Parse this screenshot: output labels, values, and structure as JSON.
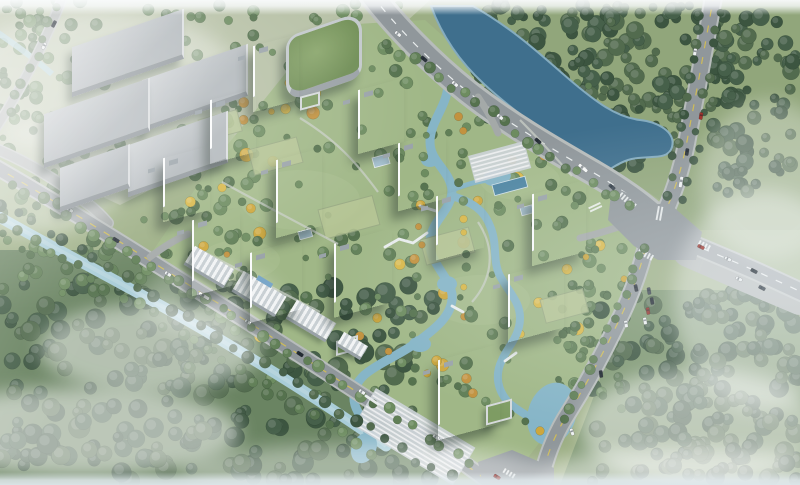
{
  "meta": {
    "title": "aerial-residential-development-render",
    "viewport": {
      "w": 800,
      "h": 485
    },
    "description": "Bird's-eye architectural rendering: riverside residential compound of white high-rise towers with landscaped gardens and winding stream, bounded by arterial roads, a large intersection, canal, warehouses and forest"
  },
  "palette": {
    "base": "#9cae84",
    "paleField": "#b6c0a5",
    "grassNE": "#91a67b",
    "forestBaseSW": "#6a8462",
    "forestBaseSE": "#7d9670",
    "lawn": "#a0b787",
    "lawnLight": "#aabf90",
    "courtyard": "#b7c696",
    "courtyardEdge": "#98a883",
    "river": "#3f6f8d",
    "riverEdge": "#85acbf",
    "canal": "#a9cdd8",
    "canalLight": "#c6dee5",
    "stream": "#86b5c7",
    "pool": "#4f86a3",
    "pavilion": "#a8c3d2",
    "roadAsphalt": "#90979b",
    "roadSide": "#b7bcbb",
    "roadMinor": "#a4a9a8",
    "laneWhite": "#f3f6f6",
    "laneYellow": "#d6c050",
    "greensDark": [
      "#3c5540",
      "#46604a",
      "#526b4e"
    ],
    "greensMid": [
      "#55724e",
      "#617f57",
      "#6d8c60"
    ],
    "yellows": [
      "#cda73d",
      "#c2923f",
      "#d8b84a"
    ],
    "pathGrey": "#c9cfc7",
    "terrace": "#ccd3d7",
    "terraceLine": "#eef0f1",
    "bridge": "#e9edee",
    "mist": "#ffffff",
    "towerGlassA": "#5d7282",
    "towerGlassB": "#6b8090",
    "towerRoof": "#eef1f3",
    "hvac": "#9aa3a9"
  },
  "scene": {
    "ground": [
      {
        "name": "field-top-left",
        "pts": "0,0 430,0 370,55 250,140 120,205 0,150",
        "fill": "#b6c0a5"
      },
      {
        "name": "grass-north-east",
        "pts": "430,0 800,0 800,230 700,230 660,200 600,160 520,110 460,55",
        "fill": "#91a67b"
      },
      {
        "name": "forest-floor-south-west",
        "pts": "0,250 120,250 250,330 420,440 430,485 0,485",
        "fill": "#6a8462"
      },
      {
        "name": "forest-floor-south-east",
        "pts": "600,290 800,290 800,485 560,485 600,380",
        "fill": "#7d9670"
      },
      {
        "name": "compound-lawn",
        "pts": "150,255 215,160 260,105 300,55 340,25 425,20 470,60 530,100 590,145 648,208 636,300 566,408 520,468 470,465 420,436 355,392 250,318",
        "fill": "#a0b787"
      }
    ],
    "lawnBlotches": [
      [
        300,
        200,
        60,
        30
      ],
      [
        480,
        300,
        50,
        25
      ],
      [
        240,
        260,
        40,
        20
      ],
      [
        520,
        180,
        40,
        20
      ],
      [
        200,
        140,
        36,
        18
      ]
    ],
    "forest": [
      {
        "x": 60,
        "y": 0,
        "w": 350,
        "h": 115,
        "n": 60,
        "seed": 11,
        "pal": "greensMid",
        "rmin": 3,
        "rmax": 7
      },
      {
        "x": 478,
        "y": 5,
        "w": 245,
        "h": 112,
        "n": 150,
        "seed": 22,
        "pal": "greensDark",
        "rmin": 4,
        "rmax": 9
      },
      {
        "x": 712,
        "y": 8,
        "w": 88,
        "h": 185,
        "n": 80,
        "seed": 33,
        "pal": "greensDark",
        "rmin": 4,
        "rmax": 9
      },
      {
        "x": 596,
        "y": 92,
        "w": 95,
        "h": 75,
        "n": 35,
        "seed": 44,
        "pal": "greensDark",
        "rmin": 3,
        "rmax": 8
      },
      {
        "x": 0,
        "y": 282,
        "w": 435,
        "h": 200,
        "n": 240,
        "seed": 55,
        "pal": "greensDark",
        "rmin": 5,
        "rmax": 11
      },
      {
        "x": 0,
        "y": 140,
        "w": 255,
        "h": 155,
        "n": 85,
        "seed": 66,
        "pal": "greensMid",
        "rmin": 3,
        "rmax": 8
      },
      {
        "x": 592,
        "y": 292,
        "w": 208,
        "h": 190,
        "n": 180,
        "seed": 77,
        "pal": "greensDark",
        "rmin": 5,
        "rmax": 10
      },
      {
        "x": 160,
        "y": 80,
        "w": 430,
        "h": 320,
        "n": 170,
        "seed": 88,
        "pal": "greensMid",
        "rmin": 3,
        "rmax": 7,
        "yellow": 0.22
      },
      {
        "x": 552,
        "y": 240,
        "w": 75,
        "h": 175,
        "n": 50,
        "seed": 99,
        "pal": "greensMid",
        "rmin": 3,
        "rmax": 6,
        "yellow": 0.1
      },
      {
        "x": 0,
        "y": 0,
        "w": 70,
        "h": 140,
        "n": 40,
        "seed": 111,
        "pal": "greensMid",
        "rmin": 3,
        "rmax": 7
      }
    ],
    "water": {
      "river": {
        "d": "M431,6 C442,36 460,62 484,84 C512,110 544,132 572,150 C584,158 594,168 598,178 C606,172 616,164 628,160 C646,154 668,162 672,147 C676,132 658,122 640,120 C616,117 596,102 570,80 C544,58 518,32 473,6 Z"
      },
      "canal": {
        "d": "M-6,214 C60,252 140,292 214,336 C278,374 332,408 386,446",
        "w": 11
      },
      "canalTopLeft": {
        "d": "M-6,30 C14,44 34,58 52,74",
        "w": 6
      },
      "stream": [
        {
          "d": "M448,86 C446,108 430,122 430,142 C430,162 450,170 452,190 C452,210 432,220 430,240 C428,262 448,274 452,294 C454,314 436,328 420,340 C402,354 384,360 368,372 C354,382 350,398 358,412 C362,420 366,428 370,436",
          "w": 9
        },
        {
          "d": "M452,196 C472,202 484,210 490,226 C498,244 492,260 500,276 C510,294 520,302 520,318 C520,336 508,346 502,360 C494,376 498,392 510,404 C522,414 534,418 544,428 C552,436 554,446 552,456",
          "w": 8
        },
        {
          "d": "M452,190 C468,184 480,180 494,180",
          "w": 5
        }
      ],
      "ponds": [
        {
          "cx": 430,
          "cy": 160,
          "rx": 9,
          "ry": 7,
          "rot": 0
        },
        {
          "cx": 447,
          "cy": 284,
          "rx": 10,
          "ry": 8,
          "rot": 0
        },
        {
          "cx": 420,
          "cy": 344,
          "rx": 11,
          "ry": 8,
          "rot": 0
        },
        {
          "cx": 497,
          "cy": 177,
          "rx": 14,
          "ry": 9,
          "rot": -10
        },
        {
          "cx": 552,
          "cy": 414,
          "rx": 24,
          "ry": 32,
          "rot": 18
        },
        {
          "cx": 364,
          "cy": 448,
          "rx": 12,
          "ry": 16,
          "rot": 28
        }
      ],
      "pools": [
        {
          "x": 492,
          "y": 185,
          "w": 34,
          "h": 11,
          "a": -15
        }
      ]
    },
    "roads": [
      {
        "name": "road-left-edge",
        "d": "M64,-6 C50,30 30,72 6,112 L-8,134",
        "w": 8,
        "side": 11,
        "col": "minor"
      },
      {
        "name": "road-west-connector",
        "d": "M-6,148 C28,162 60,182 88,204 C96,210 102,216 108,223",
        "w": 9,
        "side": 12,
        "col": "minor"
      },
      {
        "name": "road-sw-perimeter",
        "d": "M-6,166 C60,204 130,248 200,292 C268,334 332,376 394,416 C432,440 462,462 492,484 L500,492",
        "w": 13,
        "side": 17,
        "line": "y"
      },
      {
        "name": "road-main-north",
        "d": "M371,-6 C394,24 430,62 468,92 C510,125 556,151 594,173 C618,187 638,201 654,215",
        "w": 21,
        "side": 27,
        "line": "w"
      },
      {
        "name": "road-north-vertical",
        "d": "M714,-6 C706,40 697,90 689,130 C684,160 677,186 665,212",
        "w": 15,
        "side": 19,
        "line": "y"
      },
      {
        "name": "road-east-perimeter",
        "d": "M652,216 C647,248 637,282 622,314 C606,348 589,380 569,412 C556,432 548,452 543,472 L541,492",
        "w": 14,
        "side": 18,
        "line": "y"
      },
      {
        "name": "parking-apron",
        "d": "M688,252 C720,266 752,280 800,300",
        "w": 30,
        "col": "minor"
      },
      {
        "name": "road-south-east",
        "d": "M658,230 C692,244 726,258 758,272 L808,295",
        "w": 16,
        "side": 20,
        "line": "w"
      },
      {
        "name": "entrance-north",
        "d": "M478,97 C487,110 493,121 498,133",
        "w": 7,
        "col": "minor"
      },
      {
        "name": "entrance-east",
        "d": "M636,221 C616,228 598,234 580,238",
        "w": 7,
        "col": "minor"
      },
      {
        "name": "entrance-sw",
        "d": "M150,257 C162,248 174,240 188,234",
        "w": 7,
        "col": "minor"
      }
    ],
    "junctions": [
      {
        "name": "intersection-main",
        "pts": "612,186 650,204 670,204 702,232 696,260 658,260 634,246 608,220"
      },
      {
        "name": "junction-south",
        "pts": "478,462 512,450 554,468 554,490 484,490"
      }
    ],
    "crosswalks": [
      [
        622,
        192,
        18,
        6,
        40
      ],
      [
        658,
        206,
        6,
        14,
        10
      ],
      [
        640,
        248,
        16,
        6,
        28
      ],
      [
        600,
        202,
        6,
        13,
        65
      ],
      [
        700,
        240,
        14,
        5,
        28
      ],
      [
        505,
        468,
        13,
        5,
        31
      ]
    ],
    "terraces": [
      {
        "x": 376,
        "y": 388,
        "w": 116,
        "h": 44,
        "a": 31
      },
      {
        "x": 468,
        "y": 156,
        "w": 58,
        "h": 28,
        "a": -15
      }
    ],
    "courtyards": [
      [
        248,
        150,
        50,
        26
      ],
      [
        318,
        210,
        56,
        30
      ],
      [
        420,
        240,
        50,
        26
      ],
      [
        198,
        120,
        40,
        22
      ],
      [
        540,
        300,
        44,
        24
      ]
    ],
    "pavilions": [
      [
        372,
        158,
        16,
        10
      ],
      [
        298,
        232,
        13,
        8
      ],
      [
        520,
        208,
        12,
        8
      ]
    ],
    "paths": [
      "M300,118 C336,140 356,162 378,192",
      "M222,182 C262,204 300,224 338,244",
      "M478,222 C498,252 490,282 472,302",
      "M200,250 C240,270 280,292 320,312",
      "M520,120 C540,140 556,158 572,176"
    ],
    "treeRows": [
      [
        388,
        44,
        630,
        208,
        20,
        4,
        6,
        "greensMid",
        201,
        0
      ],
      [
        722,
        12,
        686,
        196,
        12,
        3.5,
        5.5,
        "greensDark",
        202,
        0
      ],
      [
        700,
        14,
        666,
        192,
        12,
        3.5,
        5.5,
        "greensDark",
        203,
        0
      ],
      [
        646,
        246,
        566,
        418,
        15,
        3.5,
        6,
        "greensMid",
        204,
        0
      ],
      [
        14,
        182,
        470,
        462,
        34,
        4,
        6.5,
        "greensMid",
        205,
        0
      ],
      [
        2,
        202,
        450,
        478,
        30,
        4,
        6.5,
        "greensDark",
        206,
        0
      ],
      [
        4,
        222,
        372,
        452,
        26,
        4,
        6,
        "greensMid",
        207,
        0
      ],
      [
        58,
        10,
        8,
        112,
        8,
        3.5,
        5.5,
        "greensMid",
        208,
        0
      ],
      [
        424,
        118,
        414,
        332,
        13,
        3,
        5,
        "greensMid",
        209,
        0.5
      ],
      [
        460,
        118,
        464,
        300,
        12,
        3,
        5,
        "greensMid",
        210,
        0.5
      ],
      [
        390,
        352,
        540,
        430,
        12,
        3,
        5,
        "greensMid",
        211,
        0.35
      ]
    ],
    "bridges": [
      "M420,206 L436,211",
      "M385,247 L399,239 L413,243 L427,233",
      "M452,306 L463,312",
      "M366,396 L378,404",
      "M505,361 L516,353"
    ],
    "mist": [
      [
        150,
        348,
        110,
        45,
        0.5
      ],
      [
        80,
        432,
        160,
        45,
        0.55
      ],
      [
        360,
        472,
        180,
        28,
        0.4
      ],
      [
        700,
        428,
        120,
        60,
        0.5
      ],
      [
        764,
        300,
        90,
        110,
        0.38
      ],
      [
        100,
        80,
        140,
        70,
        0.35
      ],
      [
        30,
        180,
        90,
        55,
        0.4
      ],
      [
        690,
        478,
        160,
        30,
        0.5
      ],
      [
        210,
        300,
        70,
        35,
        0.28
      ],
      [
        770,
        180,
        70,
        80,
        0.3
      ]
    ],
    "cars": [
      [
        398,
        34,
        38,
        "#eef1f2"
      ],
      [
        424,
        59,
        40,
        "#2c343d"
      ],
      [
        455,
        84,
        40,
        "#eef1f2"
      ],
      [
        500,
        117,
        40,
        "#eef1f2"
      ],
      [
        538,
        141,
        41,
        "#2c343d"
      ],
      [
        583,
        168,
        41,
        "#f4f6f6",
        11
      ],
      [
        612,
        187,
        42,
        "#3a4550"
      ],
      [
        695,
        52,
        99,
        "#eef1f2"
      ],
      [
        701,
        116,
        99,
        "#a2362e"
      ],
      [
        687,
        152,
        99,
        "#2c343d"
      ],
      [
        681,
        182,
        100,
        "#eef1f2",
        11
      ],
      [
        636,
        288,
        78,
        "#2c343d"
      ],
      [
        626,
        324,
        80,
        "#eef1f2"
      ],
      [
        601,
        374,
        83,
        "#1d252d"
      ],
      [
        572,
        432,
        70,
        "#eef1f2"
      ],
      [
        497,
        477,
        32,
        "#a2362e"
      ],
      [
        649,
        291,
        80,
        "#39434d"
      ],
      [
        652,
        301,
        80,
        "#1f2730"
      ],
      [
        648,
        311,
        80,
        "#8e2f28"
      ],
      [
        645,
        321,
        80,
        "#eef1f2"
      ],
      [
        701,
        247,
        26,
        "#a2362e"
      ],
      [
        728,
        259,
        27,
        "#eef1f2"
      ],
      [
        754,
        271,
        27,
        "#242d36"
      ],
      [
        739,
        279,
        27,
        "#eef1f2"
      ],
      [
        762,
        288,
        27,
        "#39434d"
      ],
      [
        70,
        210,
        31,
        "#eef1f2"
      ],
      [
        116,
        240,
        32,
        "#2c343d"
      ],
      [
        168,
        274,
        32,
        "#eef1f2"
      ],
      [
        204,
        296,
        32,
        "#f6f7f7",
        12
      ],
      [
        248,
        322,
        32,
        "#eef1f2"
      ],
      [
        300,
        354,
        33,
        "#232b33"
      ],
      [
        362,
        392,
        33,
        "#eef1f2"
      ],
      [
        436,
        437,
        33,
        "#eef1f2"
      ],
      [
        44,
        46,
        117,
        "#eef1f2"
      ],
      [
        54,
        24,
        117,
        "#2c343d"
      ]
    ],
    "buildings": {
      "towers": [
        {
          "x": 253,
          "y": 40,
          "w": 46,
          "h": 66
        },
        {
          "x": 210,
          "y": 94,
          "w": 46,
          "h": 64
        },
        {
          "x": 358,
          "y": 84,
          "w": 46,
          "h": 64
        },
        {
          "x": 398,
          "y": 137,
          "w": 48,
          "h": 68
        },
        {
          "x": 163,
          "y": 152,
          "w": 47,
          "h": 64
        },
        {
          "x": 276,
          "y": 154,
          "w": 46,
          "h": 78
        },
        {
          "x": 192,
          "y": 214,
          "w": 48,
          "h": 76
        },
        {
          "x": 250,
          "y": 246,
          "w": 52,
          "h": 70
        },
        {
          "x": 334,
          "y": 236,
          "w": 58,
          "h": 74
        },
        {
          "x": 436,
          "y": 190,
          "w": 48,
          "h": 64
        },
        {
          "x": 532,
          "y": 187,
          "w": 54,
          "h": 72
        },
        {
          "x": 508,
          "y": 267,
          "w": 56,
          "h": 68
        },
        {
          "x": 438,
          "y": 352,
          "w": 62,
          "h": 80
        }
      ],
      "greenRoof": {
        "x": 286,
        "y": 24,
        "w": 76,
        "h": 66
      },
      "annexes": [
        [
          486,
          402,
          26,
          20
        ],
        [
          336,
          338,
          22,
          15
        ],
        [
          300,
          94,
          20,
          14
        ]
      ],
      "warehouses": [
        [
          72,
          28,
          112,
          50
        ],
        [
          142,
          62,
          106,
          52
        ],
        [
          44,
          96,
          106,
          54
        ],
        [
          128,
          128,
          100,
          52
        ],
        [
          60,
          156,
          70,
          44
        ]
      ],
      "podium": [
        {
          "x": 186,
          "y": 256,
          "w": 46,
          "h": 22
        },
        {
          "x": 234,
          "y": 282,
          "w": 50,
          "h": 24,
          "aw": true
        },
        {
          "x": 288,
          "y": 310,
          "w": 46,
          "h": 22
        },
        {
          "x": 338,
          "y": 338,
          "w": 28,
          "h": 16
        }
      ]
    }
  }
}
